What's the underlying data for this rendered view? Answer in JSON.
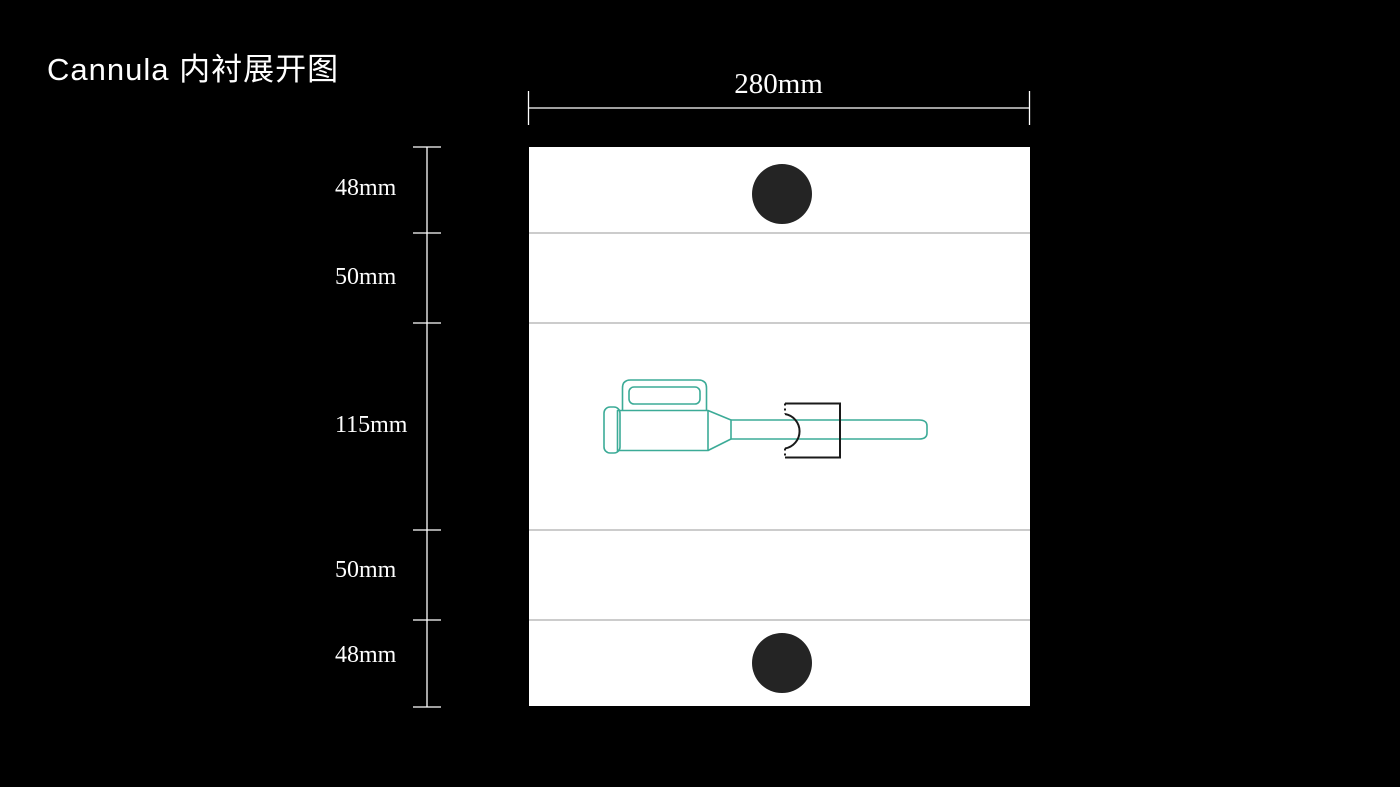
{
  "title": "Cannula 内衬展开图",
  "dimensions": {
    "width": {
      "label": "280mm"
    },
    "segments": [
      {
        "label": "48mm"
      },
      {
        "label": "50mm"
      },
      {
        "label": "115mm"
      },
      {
        "label": "50mm"
      },
      {
        "label": "48mm"
      }
    ]
  },
  "colors": {
    "background": "#000000",
    "panel": "#ffffff",
    "fold_line": "#999999",
    "hole": "#242424",
    "cannula_outline": "#3cab97",
    "clip_outline": "#1a1a1a",
    "dimension_line": "#ffffff"
  }
}
